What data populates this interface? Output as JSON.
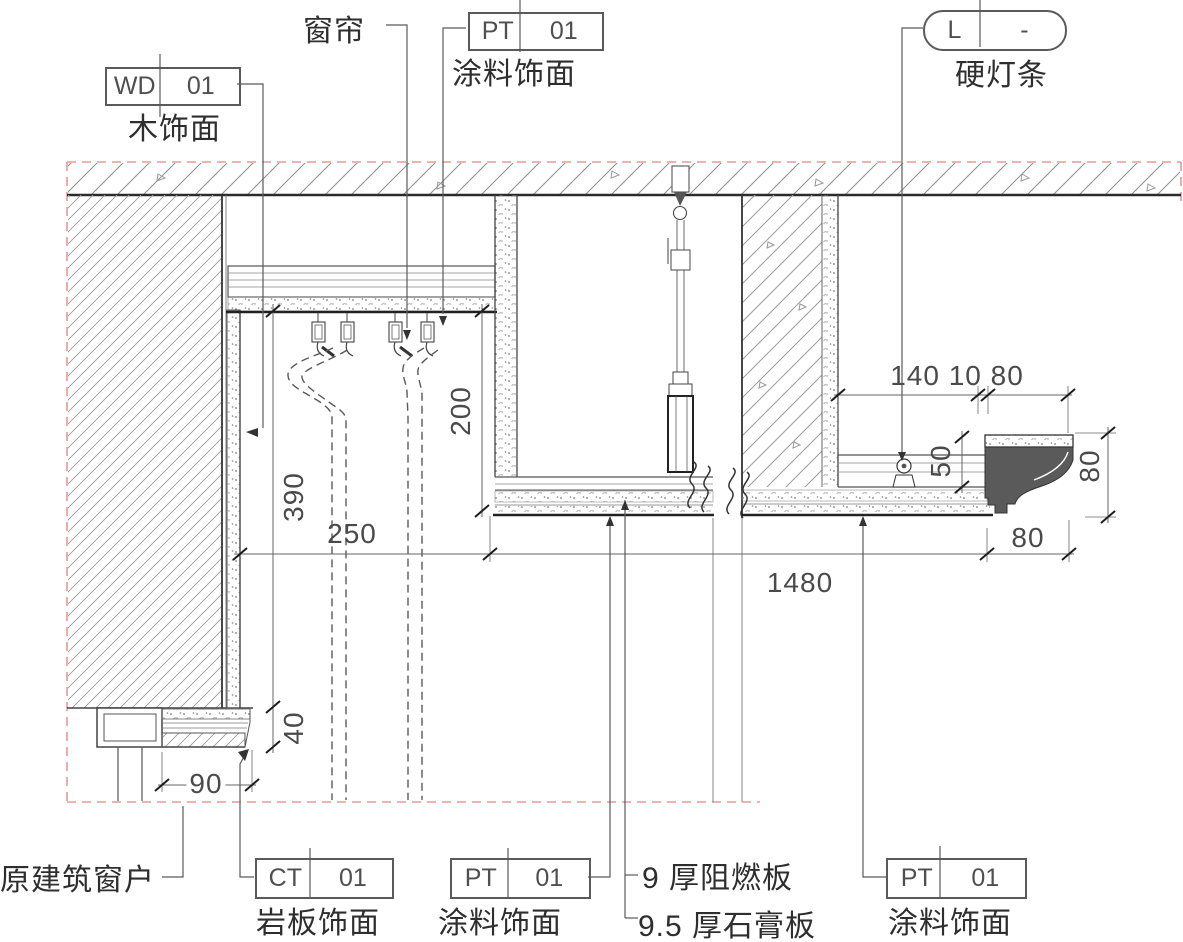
{
  "tags": {
    "wd01": {
      "code": "WD",
      "num": "01",
      "label": "木饰面"
    },
    "pt_top": {
      "code": "PT",
      "num": "01",
      "label": "涂料饰面"
    },
    "light": {
      "code": "L",
      "num": "-",
      "label": "硬灯条"
    },
    "ct01": {
      "code": "CT",
      "num": "01",
      "label": "岩板饰面"
    },
    "pt_bc": {
      "code": "PT",
      "num": "01",
      "label": "涂料饰面"
    },
    "pt_br": {
      "code": "PT",
      "num": "01",
      "label": "涂料饰面"
    }
  },
  "notes": {
    "curtain": "窗帘",
    "original_window": "原建筑窗户",
    "flame_board": "9 厚阻燃板",
    "gypsum_board": "9.5 厚石膏板"
  },
  "dims": {
    "v390": "390",
    "v40": "40",
    "v200": "200",
    "h250": "250",
    "h1480": "1480",
    "h90": "90",
    "top_right": "140 10 80",
    "v50": "50",
    "v80": "80",
    "h80": "80"
  },
  "colors": {
    "boundary_red": "#e89898",
    "cornice_fill": "#5a5a5a",
    "line": "#4a4a4a"
  }
}
